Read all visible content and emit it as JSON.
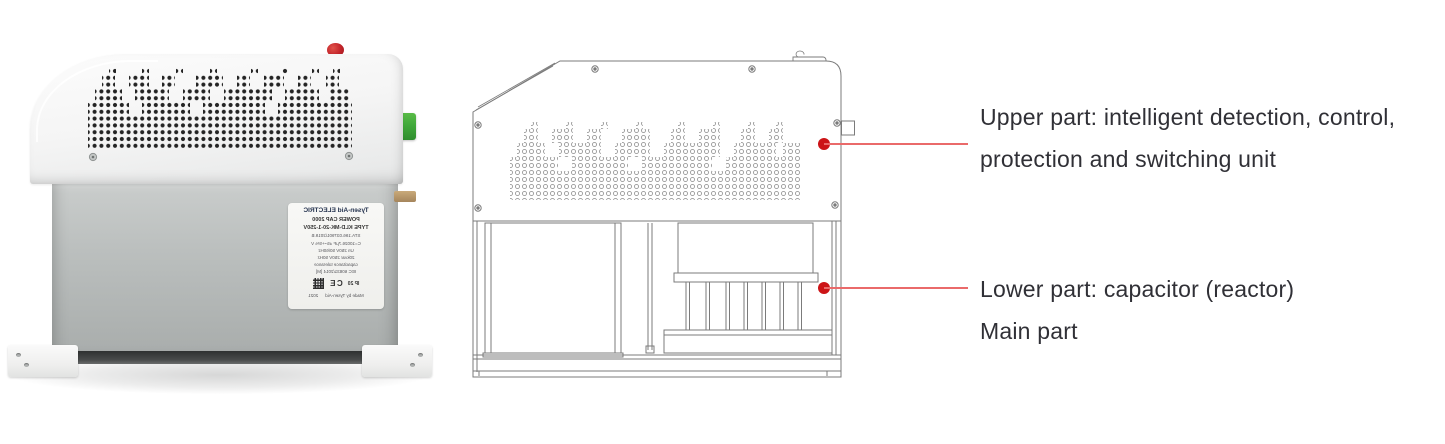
{
  "annotations": {
    "upper": {
      "line1": "Upper part: intelligent detection, control,",
      "line2": "protection and switching unit"
    },
    "lower": {
      "line1": "Lower part: capacitor (reactor)",
      "line2": "Main part"
    }
  },
  "product_label": {
    "brand": "Tysen-Aid ELECTRIC",
    "line2": "POWER CAP 2000",
    "line3": "TYPE KLD-MK-20-1-250V",
    "line4": "STA.196.037901/2019.B",
    "line5": "C=10026.7μF  ±5~+5%  V",
    "line6": "Un 250V  50/60Hz",
    "line7": "20kvar  250V  50Hz",
    "line8": "capacitance tolerance",
    "line9": "IEC 60831/2014  [M]",
    "ip_rating": "IP 20",
    "ce_mark": "CE",
    "footer": "Made by Tysen-Aid",
    "year": "2021"
  },
  "colors": {
    "callout_dot_red": "#cc1417",
    "callout_line_red": "#ea6a6a",
    "indicator_button_red": "#c3242a",
    "terminal_green": "#41a93a",
    "drawing_line_gray": "#7b7b7b",
    "annotation_text": "#303036",
    "body_gray": "#b4b8b7",
    "housing_white": "#f5f5f5"
  }
}
